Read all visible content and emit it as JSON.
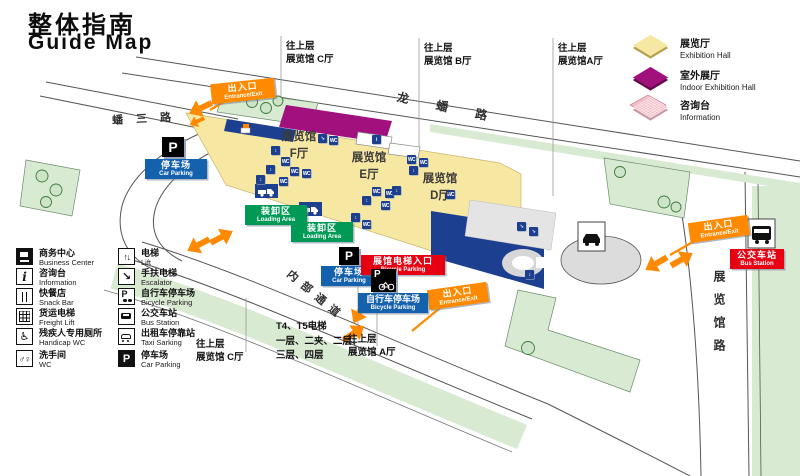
{
  "title": {
    "zh": "整体指南",
    "en": "Guide Map"
  },
  "legend": {
    "swatches": [
      {
        "zh": "展览厅",
        "en": "Exhibition Hall"
      },
      {
        "zh": "室外展厅",
        "en": "Indoor Exhibition Hall"
      },
      {
        "zh": "咨询台",
        "en": "Information"
      }
    ],
    "col1": [
      {
        "icon": "business-center",
        "zh": "商务中心",
        "en": "Business Center"
      },
      {
        "icon": "information",
        "zh": "咨询台",
        "en": "Information"
      },
      {
        "icon": "snack-bar",
        "zh": "快餐店",
        "en": "Snack Bar"
      },
      {
        "icon": "freight-lift",
        "zh": "货运电梯",
        "en": "Freight Lift"
      },
      {
        "icon": "handicap-wc",
        "zh": "残疾人专用厕所",
        "en": "Handicap WC"
      },
      {
        "icon": "wc",
        "zh": "洗手间",
        "en": "WC"
      }
    ],
    "col2": [
      {
        "icon": "lift",
        "zh": "电梯",
        "en": "Lift"
      },
      {
        "icon": "escalator",
        "zh": "手扶电梯",
        "en": "Escalator"
      },
      {
        "icon": "bicycle-parking",
        "zh": "自行车停车场",
        "en": "Bicycle Parking"
      },
      {
        "icon": "bus-station",
        "zh": "公交车站",
        "en": "Bus Station"
      },
      {
        "icon": "taxi",
        "zh": "出租车停靠站",
        "en": "Taxi Sarking"
      },
      {
        "icon": "car-parking",
        "zh": "停车场",
        "en": "Car Parking"
      }
    ]
  },
  "roads": {
    "top": "龙蟠路",
    "left": "蟠三路",
    "right": "展览馆路",
    "internal": "内部通道"
  },
  "halls": {
    "f": {
      "zh": "展览馆",
      "hall": "F厅"
    },
    "e": {
      "zh": "展览馆",
      "hall": "E厅"
    },
    "d": {
      "zh": "展览馆",
      "hall": "D厅"
    }
  },
  "links": {
    "top_c": {
      "l1": "往上层",
      "l2": "展览馆 C厅"
    },
    "top_b": {
      "l1": "往上层",
      "l2": "展览馆 B厅"
    },
    "top_a": {
      "l1": "往上层",
      "l2": "展览馆A厅"
    },
    "bottom_c": {
      "l1": "往上层",
      "l2": "展览馆 C厅"
    },
    "bottom_a": {
      "l1": "往上层",
      "l2": "展览馆 A厅"
    }
  },
  "markers": {
    "entrance": {
      "zh": "出入口",
      "en": "Entrance/Exit"
    },
    "car_parking": {
      "zh": "停车场",
      "en": "Car Parking"
    },
    "bicycle_parking": {
      "zh": "自行车停车场",
      "en": "Bicycle Parking"
    },
    "hall_lift": {
      "zh": "展馆电梯入口",
      "en": "Bicycle Parking"
    },
    "loading": {
      "zh": "装卸区",
      "en": "Loading Area"
    },
    "bus_station": {
      "zh": "公交车站",
      "en": "Bus Station"
    },
    "p_symbol": "P"
  },
  "notes": {
    "l1": "T4、T5电梯",
    "l2": "一层、二夹、二层、",
    "l3": "三层、四层"
  },
  "facility_glyphs": {
    "wc": "WC",
    "lift": "↕",
    "esc": "↘",
    "info": "i"
  },
  "facility_icons": [
    {
      "x": 318,
      "y": 134,
      "t": "esc"
    },
    {
      "x": 329,
      "y": 136,
      "t": "wc"
    },
    {
      "x": 271,
      "y": 146,
      "t": "lift"
    },
    {
      "x": 281,
      "y": 157,
      "t": "wc"
    },
    {
      "x": 266,
      "y": 165,
      "t": "lift"
    },
    {
      "x": 290,
      "y": 167,
      "t": "wc"
    },
    {
      "x": 302,
      "y": 169,
      "t": "wc"
    },
    {
      "x": 256,
      "y": 175,
      "t": "lift"
    },
    {
      "x": 279,
      "y": 177,
      "t": "wc"
    },
    {
      "x": 372,
      "y": 135,
      "t": "info"
    },
    {
      "x": 407,
      "y": 155,
      "t": "wc"
    },
    {
      "x": 419,
      "y": 158,
      "t": "wc"
    },
    {
      "x": 409,
      "y": 166,
      "t": "lift"
    },
    {
      "x": 372,
      "y": 187,
      "t": "wc"
    },
    {
      "x": 385,
      "y": 189,
      "t": "wc"
    },
    {
      "x": 362,
      "y": 196,
      "t": "lift"
    },
    {
      "x": 381,
      "y": 201,
      "t": "wc"
    },
    {
      "x": 392,
      "y": 186,
      "t": "lift"
    },
    {
      "x": 351,
      "y": 213,
      "t": "lift"
    },
    {
      "x": 362,
      "y": 220,
      "t": "wc"
    },
    {
      "x": 446,
      "y": 190,
      "t": "wc"
    },
    {
      "x": 517,
      "y": 222,
      "t": "esc"
    },
    {
      "x": 529,
      "y": 227,
      "t": "esc"
    },
    {
      "x": 525,
      "y": 270,
      "t": "lift"
    }
  ],
  "colors": {
    "hall": "#f6e7a2",
    "outdoor_hall": "#a1107c",
    "info_pink": "#f2bdc6",
    "entrance_orange": "#ff8a00",
    "loading_green": "#009955",
    "parking_blue": "#1461ae",
    "station_red": "#e60012",
    "building_blue": "#1c3f8f",
    "verge_green": "#d9ead3",
    "road_line": "#555555"
  }
}
